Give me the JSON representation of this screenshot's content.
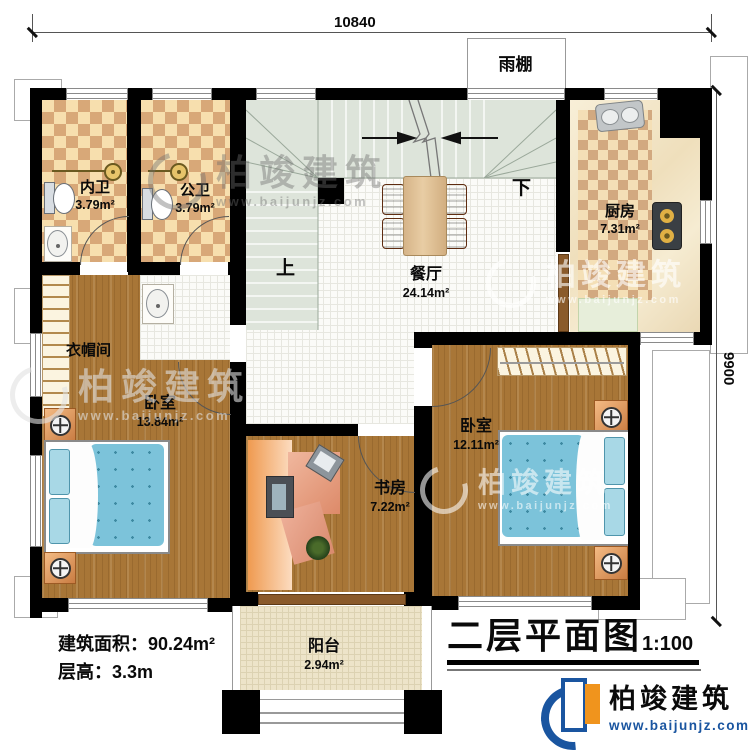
{
  "dimensions": {
    "width": "10840",
    "height": "9900"
  },
  "canopy": {
    "name": "雨棚"
  },
  "rooms": {
    "inner_bath": {
      "name": "内卫",
      "area": "3.79m²"
    },
    "public_bath": {
      "name": "公卫",
      "area": "3.79m²"
    },
    "kitchen": {
      "name": "厨房",
      "area": "7.31m²"
    },
    "dining": {
      "name": "餐厅",
      "area": "24.14m²"
    },
    "cloakroom": {
      "name": "衣帽间"
    },
    "bedroom_left": {
      "name": "卧室",
      "area": "13.84m²"
    },
    "bedroom_right": {
      "name": "卧室",
      "area": "12.11m²"
    },
    "study": {
      "name": "书房",
      "area": "7.22m²"
    },
    "balcony": {
      "name": "阳台",
      "area": "2.94m²"
    }
  },
  "stairs": {
    "up": "上",
    "down": "下"
  },
  "info": {
    "building_area": "建筑面积：90.24m²",
    "floor_height": "层高：3.3m"
  },
  "title_block": {
    "title": "二层平面图",
    "scale": "1:100"
  },
  "brand": {
    "name": "柏竣建筑",
    "website": "www.baijunjz.com"
  },
  "colors": {
    "wall": "#000000",
    "brand_blue": "#1a55a0",
    "brand_orange": "#f0941d"
  }
}
